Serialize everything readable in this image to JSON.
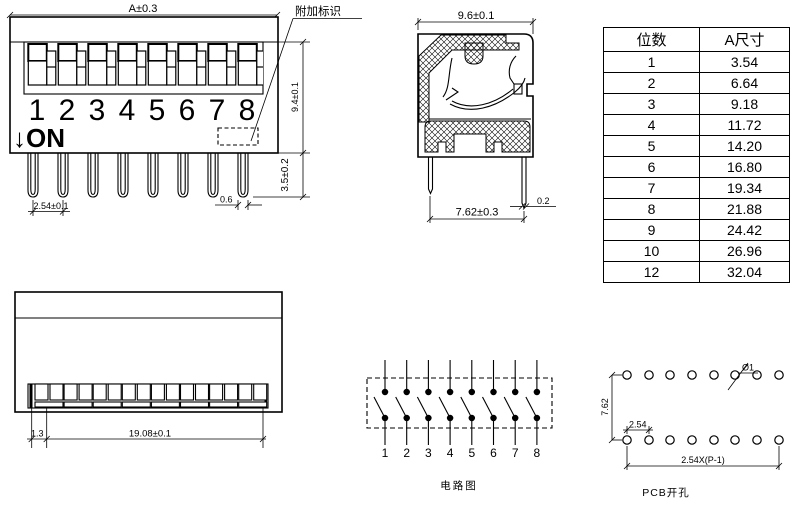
{
  "front_view": {
    "dim_width": "A±0.3",
    "dim_body_height": "9.4±0.1",
    "dim_pin_height": "3.5±0.2",
    "dim_pin_pitch": "2.54±0.1",
    "dim_pin_width": "0.6",
    "marking_label": "附加标识",
    "on_label": "↓ON",
    "switch_numbers": [
      "1",
      "2",
      "3",
      "4",
      "5",
      "6",
      "7",
      "8"
    ]
  },
  "side_view": {
    "dim_width": "9.6±0.1",
    "dim_pin_span": "7.62±0.3",
    "dim_pin_thickness": "0.2"
  },
  "size_table": {
    "headers": [
      "位数",
      "A尺寸"
    ],
    "rows": [
      [
        "1",
        "3.54"
      ],
      [
        "2",
        "6.64"
      ],
      [
        "3",
        "9.18"
      ],
      [
        "4",
        "11.72"
      ],
      [
        "5",
        "14.20"
      ],
      [
        "6",
        "16.80"
      ],
      [
        "7",
        "19.34"
      ],
      [
        "8",
        "21.88"
      ],
      [
        "9",
        "24.42"
      ],
      [
        "10",
        "26.96"
      ],
      [
        "12",
        "32.04"
      ]
    ]
  },
  "bottom_view": {
    "dim_offset": "1.3",
    "dim_span": "19.08±0.1"
  },
  "circuit": {
    "numbers": [
      "1",
      "2",
      "3",
      "4",
      "5",
      "6",
      "7",
      "8"
    ],
    "caption": "电路图"
  },
  "pcb": {
    "dim_hole_dia": "Ø1",
    "dim_row_gap": "7.62",
    "dim_pitch": "2.54",
    "dim_span": "2.54X(P-1)",
    "caption": "PCB开孔"
  }
}
